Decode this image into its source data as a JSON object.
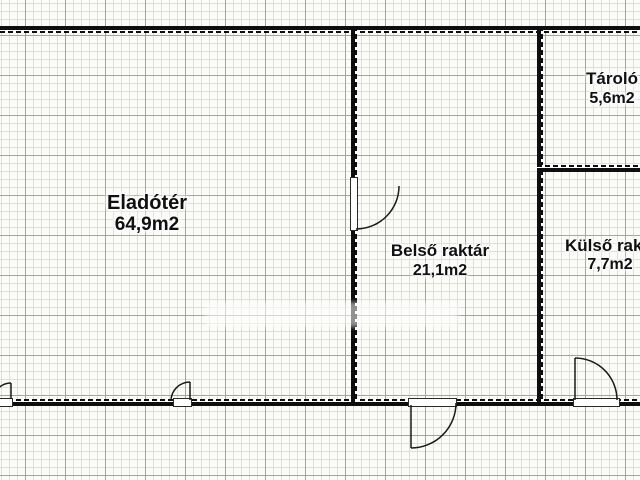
{
  "plan": {
    "type": "floor-plan",
    "rooms": [
      {
        "name": "Eladótér",
        "area": "64,9m2"
      },
      {
        "name": "Belső raktár",
        "area": "21,1m2"
      },
      {
        "name": "Tároló",
        "area": "5,6m2"
      },
      {
        "name": "Külső raktár",
        "area": "7,7m2"
      }
    ],
    "colors": {
      "wall": "#0e0e0e",
      "text": "#101010",
      "paper": "#fbfbf8",
      "grid_minor": "#dddddа",
      "grid_major": "#a3a3a0"
    }
  }
}
